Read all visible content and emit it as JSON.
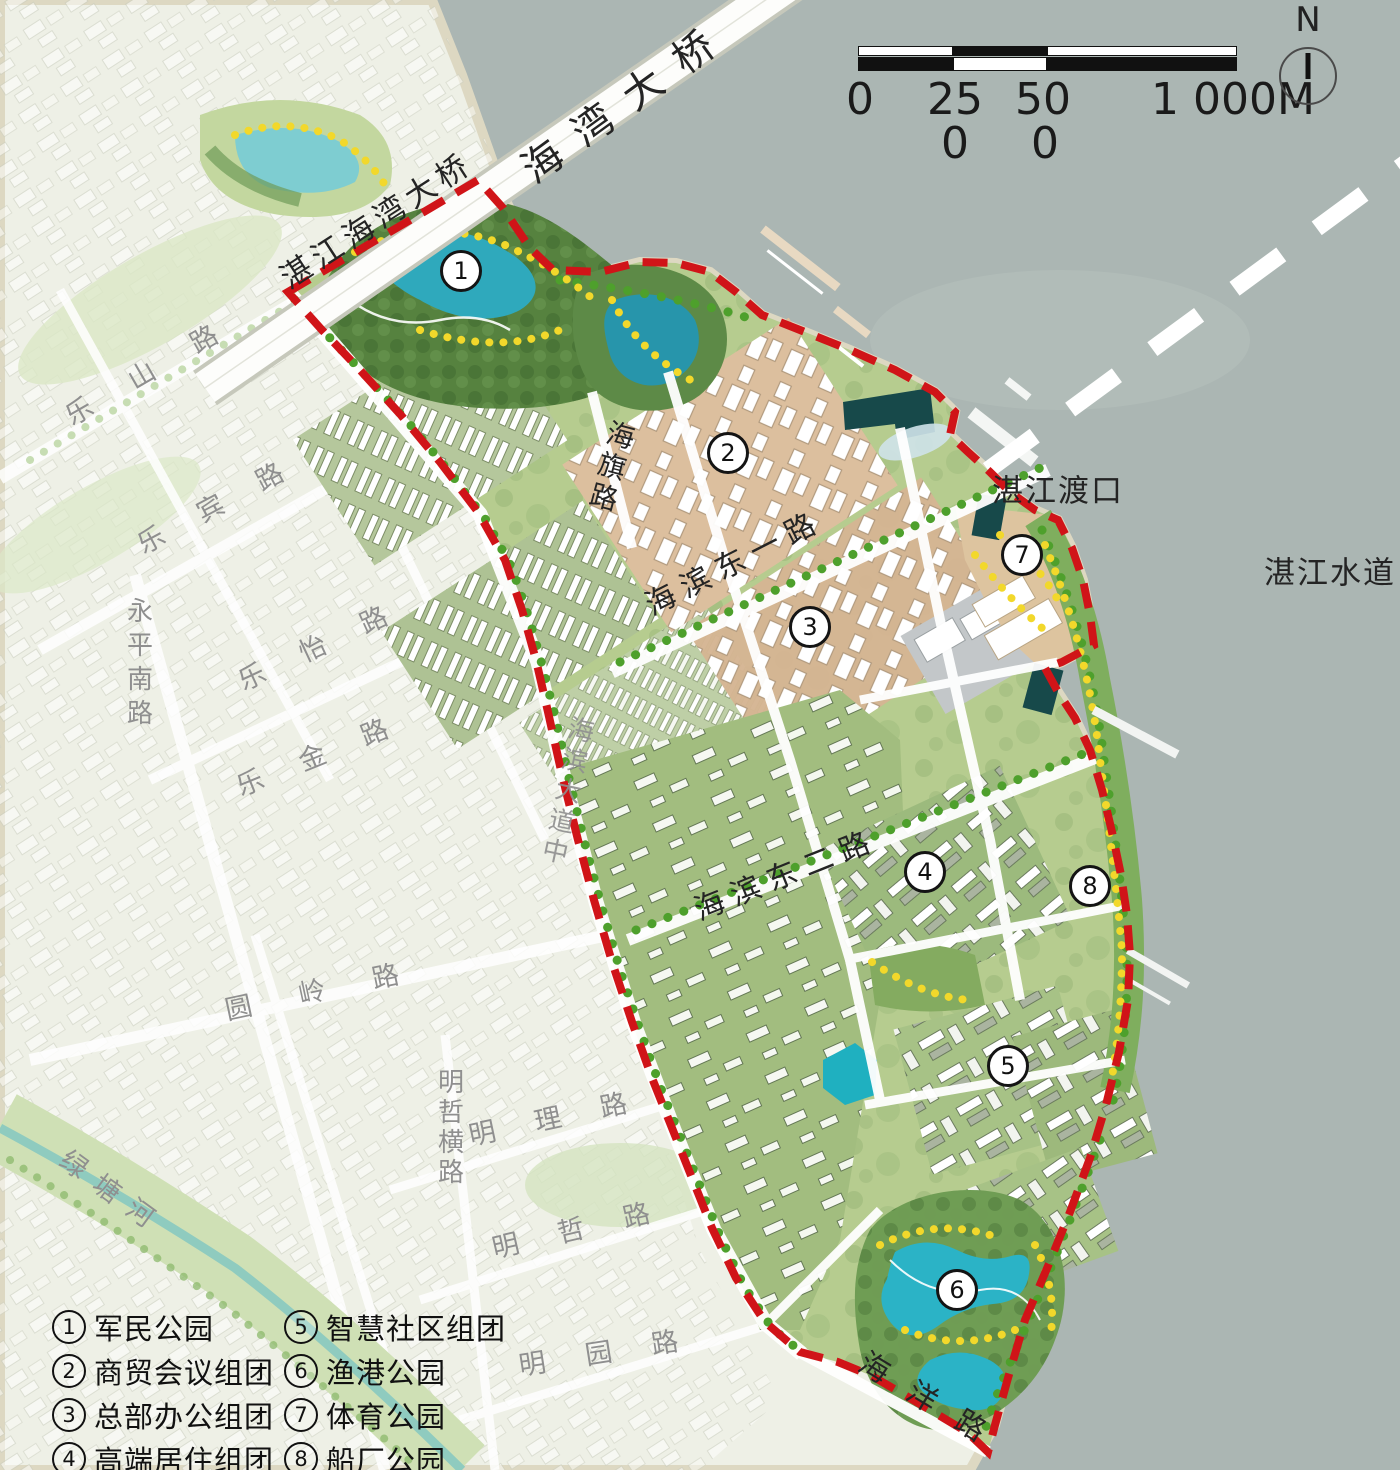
{
  "compass": {
    "label": "N"
  },
  "scale_bar": {
    "l0": "0",
    "l25": "25",
    "l50": "50",
    "l1000": "1 000M",
    "l250b": "0",
    "l500b": "0"
  },
  "labels": {
    "ferry": "湛江渡口",
    "waterway": "湛江水道",
    "bridge_main": "海湾大桥",
    "bridge_approach": "湛江海湾大桥"
  },
  "roads": {
    "leshan": "乐山路",
    "lebin": "乐宾路",
    "yongpingnan": "永平南路",
    "leyi": "乐怡路",
    "lejin": "乐金路",
    "yuanling": "圆岭路",
    "mingzheheng": "明哲横路",
    "mingli": "明理路",
    "mingzhe": "明哲路",
    "mingyuan": "明园路",
    "lvtanghe": "绿塘河",
    "haibindadaozhong": "海滨大道中",
    "haiqi": "海旗路",
    "haibindongyi": "海滨东一路",
    "haibindonger": "海滨东二路",
    "haiyang": "海洋路"
  },
  "markers": [
    {
      "num": "1"
    },
    {
      "num": "2"
    },
    {
      "num": "3"
    },
    {
      "num": "4"
    },
    {
      "num": "5"
    },
    {
      "num": "6"
    },
    {
      "num": "7"
    },
    {
      "num": "8"
    }
  ],
  "legend": {
    "items": [
      {
        "num": "1",
        "label": "军民公园"
      },
      {
        "num": "2",
        "label": "商贸会议组团"
      },
      {
        "num": "3",
        "label": "总部办公组团"
      },
      {
        "num": "4",
        "label": "高端居住组团"
      },
      {
        "num": "5",
        "label": "智慧社区组团"
      },
      {
        "num": "6",
        "label": "渔港公园"
      },
      {
        "num": "7",
        "label": "体育公园"
      },
      {
        "num": "8",
        "label": "船厂公园"
      }
    ]
  },
  "colors": {
    "water": "#abb6b3",
    "boundary_red": "#d01418",
    "lake_teal": "#2fa9bc",
    "park_green": "#56823f",
    "commercial_tan": "#dcbf9e",
    "tree_yellow": "#f2d82b"
  }
}
